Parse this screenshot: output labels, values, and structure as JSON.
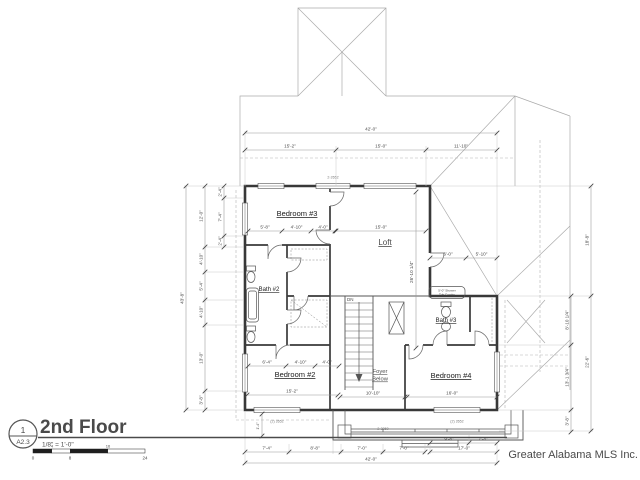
{
  "title_block": {
    "number": "1",
    "sheet": "A2.3",
    "title": "2nd Floor",
    "scale": "1/8\" = 1'-0\"",
    "bar": [
      "0",
      "4",
      "8",
      "16",
      "24"
    ]
  },
  "credit": "Greater Alabama MLS Inc.",
  "rooms": {
    "bedroom3": "Bedroom #3",
    "loft": "Loft",
    "bath2": "Bath #2",
    "bath3": "Bath #3",
    "bedroom2": "Bedroom #2",
    "foyer_line1": "Foyer",
    "foyer_line2": "Below",
    "bedroom4": "Bedroom #4"
  },
  "annotations": {
    "stair": "DN",
    "tub_line1": "5'-0\" Shower",
    "tub_line2": "Tub Combo"
  },
  "windows": {
    "top": "2-2652",
    "bottom_left": "(2) 2652",
    "bottom_right": "(2) 2652",
    "porch": "2-3050"
  },
  "dims": {
    "top_overall": "42'-0\"",
    "top": [
      "15'-2\"",
      "15'-0\"",
      "11'-10\""
    ],
    "left_overall": "43'-8\"",
    "left": [
      "12'-0\"",
      "4'-10\"",
      "5'-4\"",
      "4'-10\"",
      "13'-0\"",
      "3'-8\""
    ],
    "left_sub": [
      "2'-4\"",
      "7'-4\"",
      "2'-4\""
    ],
    "right": [
      "18'-8\"",
      "22'-6\""
    ],
    "right_sub": [
      "8'-10 1/4\"",
      "13'-1 3/4\"",
      "3'-8\""
    ],
    "bottom": [
      "7'-4\"",
      "8'-8\"",
      "7'-0\"",
      "7'-0\"",
      "9'-8\"",
      "7'-4\""
    ],
    "bottom_sub": "17'-0\"",
    "bottom_overall": "42'-0\"",
    "porch_offset": "1'-4\"",
    "bedroom3": [
      "5'-8\"",
      "4'-10\"",
      "4'-0\""
    ],
    "loft_w": "15'-0\"",
    "loft_h": "26'-10 1/4\"",
    "bath3": [
      "6'-0\"",
      "5'-10\""
    ],
    "bedroom2": [
      "6'-4\"",
      "4'-10\"",
      "4'-0\""
    ],
    "bedroom2_w": "15'-2\"",
    "foyer_w": "10'-10\"",
    "bedroom4_w": "16'-0\""
  }
}
